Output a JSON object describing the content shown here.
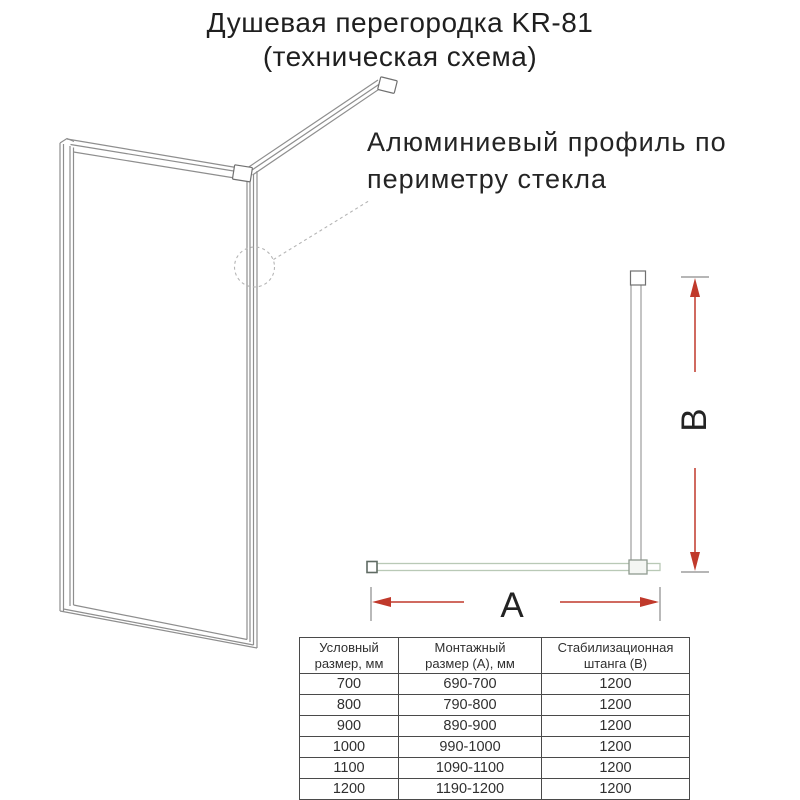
{
  "title": {
    "text": "Душевая перегородка KR-81\n(техническая схема)"
  },
  "annotation": {
    "text": "Алюминиевый профиль по\nпериметру стекла"
  },
  "dimension_labels": {
    "width": "A",
    "height": "B"
  },
  "colors": {
    "dimension_red": "#c0392b",
    "drawing_gray": "#8e8e8e",
    "glass_green": "#b9c9b6",
    "table_border": "#4a4a4a",
    "text_dark": "#262626"
  },
  "table": {
    "headers": [
      "Условный\nразмер, мм",
      "Монтажный\nразмер (А), мм",
      "Стабилизационная\nштанга (В)"
    ],
    "rows": [
      [
        "700",
        "690-700",
        "1200"
      ],
      [
        "800",
        "790-800",
        "1200"
      ],
      [
        "900",
        "890-900",
        "1200"
      ],
      [
        "1000",
        "990-1000",
        "1200"
      ],
      [
        "1100",
        "1090-1100",
        "1200"
      ],
      [
        "1200",
        "1190-1200",
        "1200"
      ]
    ]
  }
}
